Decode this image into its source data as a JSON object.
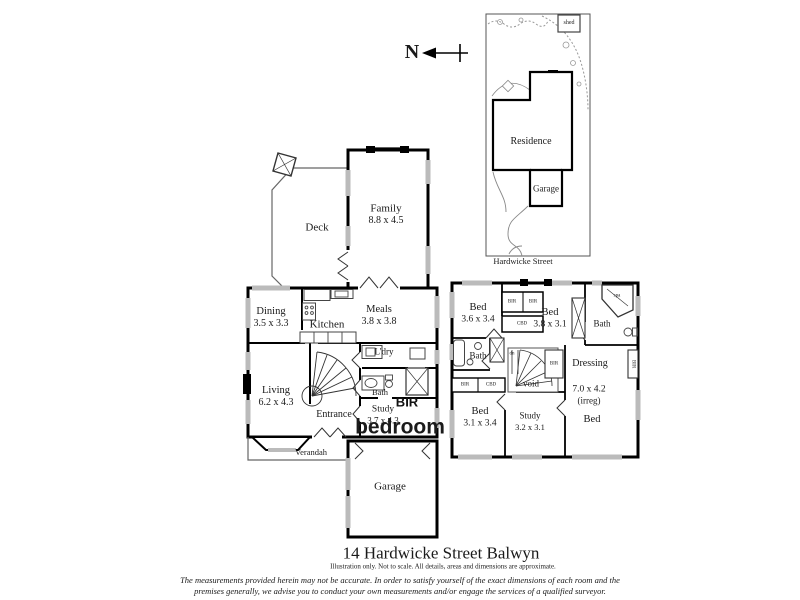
{
  "colors": {
    "wall": "#000000",
    "window": "#bbbbbb",
    "text": "#1a1a1a"
  },
  "north": {
    "label": "N"
  },
  "site_plan": {
    "shed": "shed",
    "residence": "Residence",
    "garage": "Garage",
    "street": "Hardwicke Street"
  },
  "ground_floor": {
    "deck": "Deck",
    "family_name": "Family",
    "family_dims": "8.8 x 4.5",
    "dining_name": "Dining",
    "dining_dims": "3.5 x 3.3",
    "kitchen": "Kitchen",
    "meals_name": "Meals",
    "meals_dims": "3.8 x 3.8",
    "laundry": "L'dry",
    "bath": "Bath",
    "living_name": "Living",
    "living_dims": "6.2 x 4.3",
    "entrance": "Entrance",
    "study_name": "Study",
    "study_dims": "3.7 x 4.3",
    "verandah": "Verandah",
    "garage": "Garage"
  },
  "overlay": {
    "bir": "BIR",
    "bedroom": "bedroom"
  },
  "first_floor": {
    "bed1_name": "Bed",
    "bed1_dims": "3.6 x 3.4",
    "bed2_name": "Bed",
    "bed2_dims": "3.8 x 3.1",
    "bed3_name": "Bed",
    "bed3_dims": "3.1 x 3.4",
    "bed4_dims": "7.0 x 4.2",
    "bed4_irreg": "(irreg)",
    "bed4_name": "Bed",
    "study_name": "Study",
    "study_dims": "3.2 x 3.1",
    "bath_left": "Bath",
    "bath_right": "Bath",
    "dressing": "Dressing",
    "void": "void",
    "dn": "dn",
    "spa": "spa",
    "bir": "BIR",
    "cbd": "CBD"
  },
  "footer": {
    "title": "14 Hardwicke Street Balwyn",
    "subtitle": "Illustration only. Not to scale. All details, areas and dimensions are approximate.",
    "disclaimer1": "The measurements provided herein may not be accurate.  In order  to satisfy yourself of the exact dimensions of each room and the",
    "disclaimer2": "premises generally, we advise you to conduct your own measurements and/or engage the services of a qualified surveyor."
  }
}
